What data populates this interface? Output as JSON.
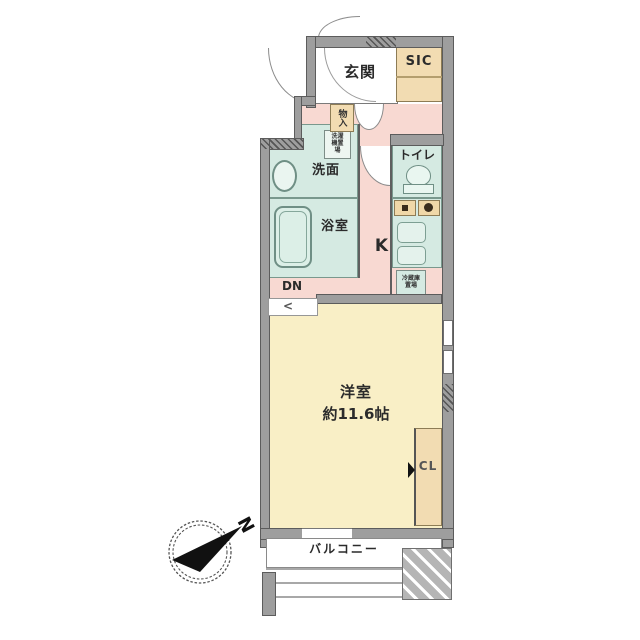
{
  "plan": {
    "entrance_label": "玄関",
    "sic_label": "SIC",
    "storage_label": "物入",
    "washer_label": "洗濯機置場",
    "washroom_label": "洗面",
    "bathroom_label": "浴室",
    "toilet_label": "トイレ",
    "kitchen_label": "K",
    "fridge_label": "冷蔵庫置場",
    "down_label": "DN",
    "step_glyph": "<",
    "main_room_label": "洋室",
    "main_room_size": "約11.6帖",
    "closet_label": "CL",
    "balcony_label": "バルコニー"
  },
  "compass": {
    "north_label": "N"
  },
  "colors": {
    "hall_pink": "#f8d9d2",
    "room_yellow": "#f9efc6",
    "wet_teal": "#d5eae2",
    "storage_tan": "#f2dcb2",
    "wall_gray": "#9e9e9e",
    "hatch_square_gray": "#b5b5b5"
  }
}
